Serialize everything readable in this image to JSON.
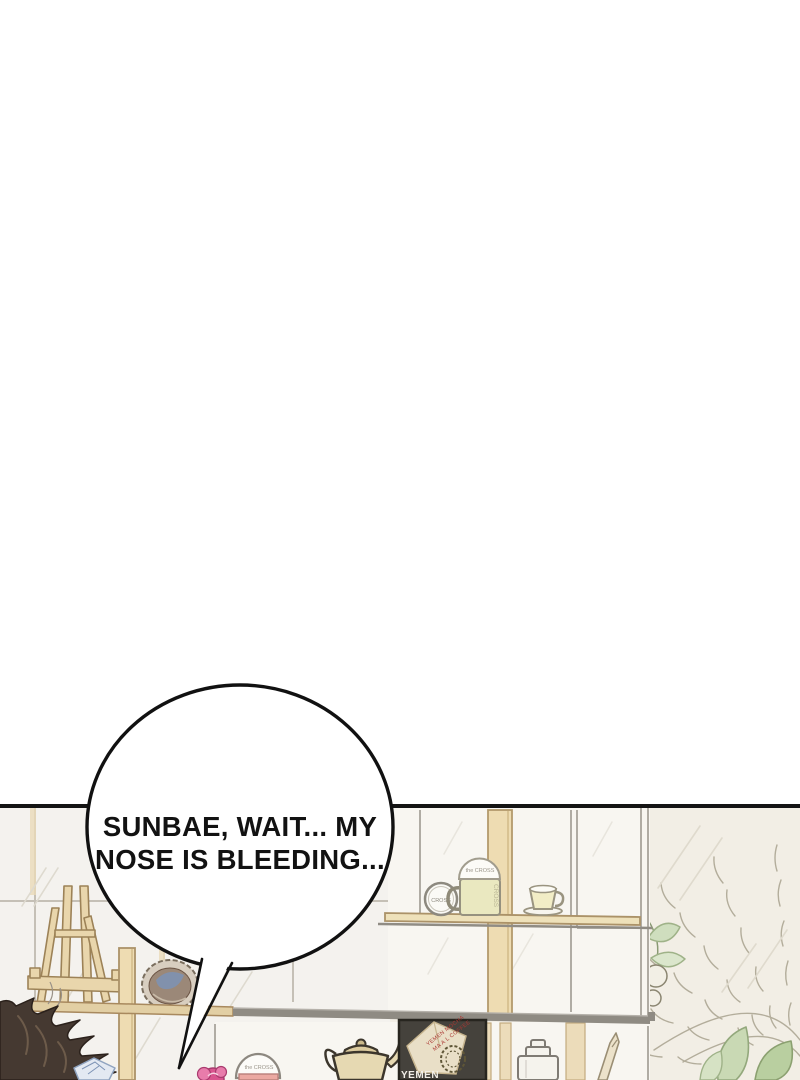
{
  "panel": {
    "bubble": {
      "line1": "SUNBAE, WAIT... MY",
      "line2": "NOSE IS BLEEDING..."
    },
    "labels": {
      "coaster": "CROSS",
      "mug_lid": "the CROSS",
      "mug_side": "CROSS",
      "tumbler": "the CROSS",
      "poster_title": "YEMEN",
      "poster_bag_line1": "YEMEN MOCHA",
      "poster_bag_line2": "MA A L COFFEE"
    },
    "colors": {
      "outline": "#141414",
      "wall": "#f2eee5",
      "tile": "#f4f2ee",
      "wood": "#eedcb2",
      "shelf_band": "#8f8b83",
      "hair": "#453931",
      "leaf_green": "#c9d9b4"
    }
  }
}
